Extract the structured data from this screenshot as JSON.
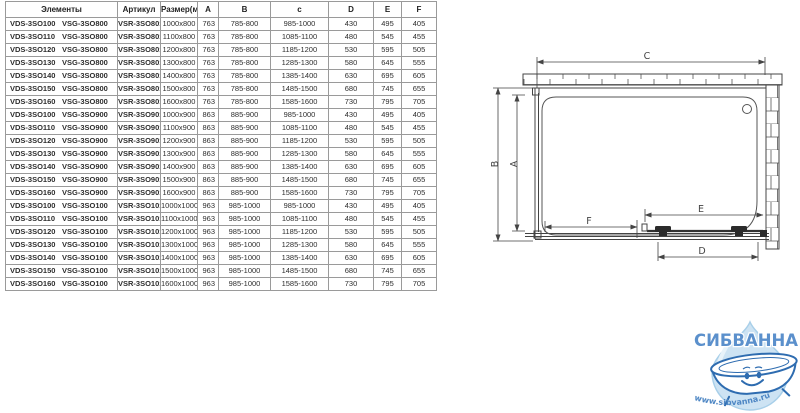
{
  "table": {
    "headers": [
      "Элементы",
      "Артикул",
      "Размер(мм)",
      "A",
      "B",
      "c",
      "D",
      "E",
      "F"
    ],
    "rows": [
      [
        "VDS-3SO100",
        "VSG-3SO800",
        "VSR-3SO8010",
        "1000x800",
        "763",
        "785-800",
        "985-1000",
        "430",
        "495",
        "405"
      ],
      [
        "VDS-3SO110",
        "VSG-3SO800",
        "VSR-3SO8011",
        "1100x800",
        "763",
        "785-800",
        "1085-1100",
        "480",
        "545",
        "455"
      ],
      [
        "VDS-3SO120",
        "VSG-3SO800",
        "VSR-3SO8012",
        "1200x800",
        "763",
        "785-800",
        "1185-1200",
        "530",
        "595",
        "505"
      ],
      [
        "VDS-3SO130",
        "VSG-3SO800",
        "VSR-3SO8013",
        "1300x800",
        "763",
        "785-800",
        "1285-1300",
        "580",
        "645",
        "555"
      ],
      [
        "VDS-3SO140",
        "VSG-3SO800",
        "VSR-3SO8014",
        "1400x800",
        "763",
        "785-800",
        "1385-1400",
        "630",
        "695",
        "605"
      ],
      [
        "VDS-3SO150",
        "VSG-3SO800",
        "VSR-3SO8015",
        "1500x800",
        "763",
        "785-800",
        "1485-1500",
        "680",
        "745",
        "655"
      ],
      [
        "VDS-3SO160",
        "VSG-3SO800",
        "VSR-3SO8016",
        "1600x800",
        "763",
        "785-800",
        "1585-1600",
        "730",
        "795",
        "705"
      ],
      [
        "VDS-3SO100",
        "VSG-3SO900",
        "VSR-3SO9010",
        "1000x900",
        "863",
        "885-900",
        "985-1000",
        "430",
        "495",
        "405"
      ],
      [
        "VDS-3SO110",
        "VSG-3SO900",
        "VSR-3SO9011",
        "1100x900",
        "863",
        "885-900",
        "1085-1100",
        "480",
        "545",
        "455"
      ],
      [
        "VDS-3SO120",
        "VSG-3SO900",
        "VSR-3SO9012",
        "1200x900",
        "863",
        "885-900",
        "1185-1200",
        "530",
        "595",
        "505"
      ],
      [
        "VDS-3SO130",
        "VSG-3SO900",
        "VSR-3SO9013",
        "1300x900",
        "863",
        "885-900",
        "1285-1300",
        "580",
        "645",
        "555"
      ],
      [
        "VDS-3SO140",
        "VSG-3SO900",
        "VSR-3SO9014",
        "1400x900",
        "863",
        "885-900",
        "1385-1400",
        "630",
        "695",
        "605"
      ],
      [
        "VDS-3SO150",
        "VSG-3SO900",
        "VSR-3SO9015",
        "1500x900",
        "863",
        "885-900",
        "1485-1500",
        "680",
        "745",
        "655"
      ],
      [
        "VDS-3SO160",
        "VSG-3SO900",
        "VSR-3SO9016",
        "1600x900",
        "863",
        "885-900",
        "1585-1600",
        "730",
        "795",
        "705"
      ],
      [
        "VDS-3SO100",
        "VSG-3SO100",
        "VSR-3SO1010",
        "1000x1000",
        "963",
        "985-1000",
        "985-1000",
        "430",
        "495",
        "405"
      ],
      [
        "VDS-3SO110",
        "VSG-3SO100",
        "VSR-3SO1011",
        "1100x1000",
        "963",
        "985-1000",
        "1085-1100",
        "480",
        "545",
        "455"
      ],
      [
        "VDS-3SO120",
        "VSG-3SO100",
        "VSR-3SO1012",
        "1200x1000",
        "963",
        "985-1000",
        "1185-1200",
        "530",
        "595",
        "505"
      ],
      [
        "VDS-3SO130",
        "VSG-3SO100",
        "VSR-3SO1013",
        "1300x1000",
        "963",
        "985-1000",
        "1285-1300",
        "580",
        "645",
        "555"
      ],
      [
        "VDS-3SO140",
        "VSG-3SO100",
        "VSR-3SO1014",
        "1400x1000",
        "963",
        "985-1000",
        "1385-1400",
        "630",
        "695",
        "605"
      ],
      [
        "VDS-3SO150",
        "VSG-3SO100",
        "VSR-3SO1015",
        "1500x1000",
        "963",
        "985-1000",
        "1485-1500",
        "680",
        "745",
        "655"
      ],
      [
        "VDS-3SO160",
        "VSG-3SO100",
        "VSR-3SO1016",
        "1600x1000",
        "963",
        "985-1000",
        "1585-1600",
        "730",
        "795",
        "705"
      ]
    ]
  },
  "diagram": {
    "labels": {
      "a": "A",
      "b": "B",
      "c": "C",
      "d": "D",
      "e": "E",
      "f": "F"
    }
  },
  "logo": {
    "brand": "СИБВАННА",
    "url": "www.sibvanna.ru",
    "brand_color": "#5b90cc",
    "drop_color": "#cde3f3",
    "outline_color": "#2e6cb0"
  }
}
